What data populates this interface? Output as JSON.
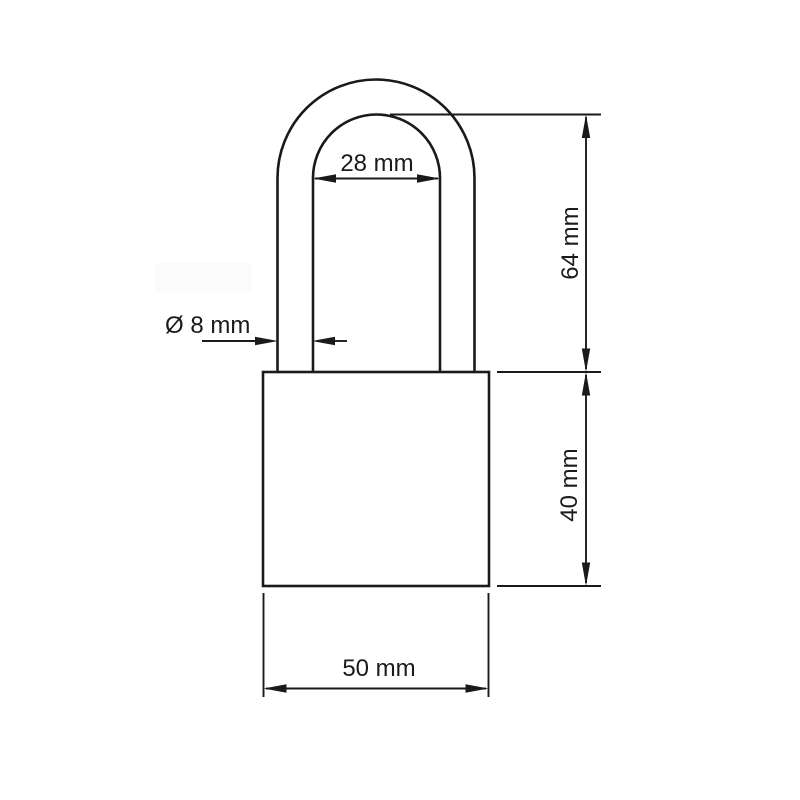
{
  "canvas": {
    "background": "#ffffff",
    "line_color": "#1a1a1a"
  },
  "drawing": {
    "dimension_labels": {
      "shackle_inner_width": "28 mm",
      "shackle_diameter": "Ø 8 mm",
      "shackle_height": "64 mm",
      "body_height": "40 mm",
      "body_width": "50 mm"
    }
  }
}
